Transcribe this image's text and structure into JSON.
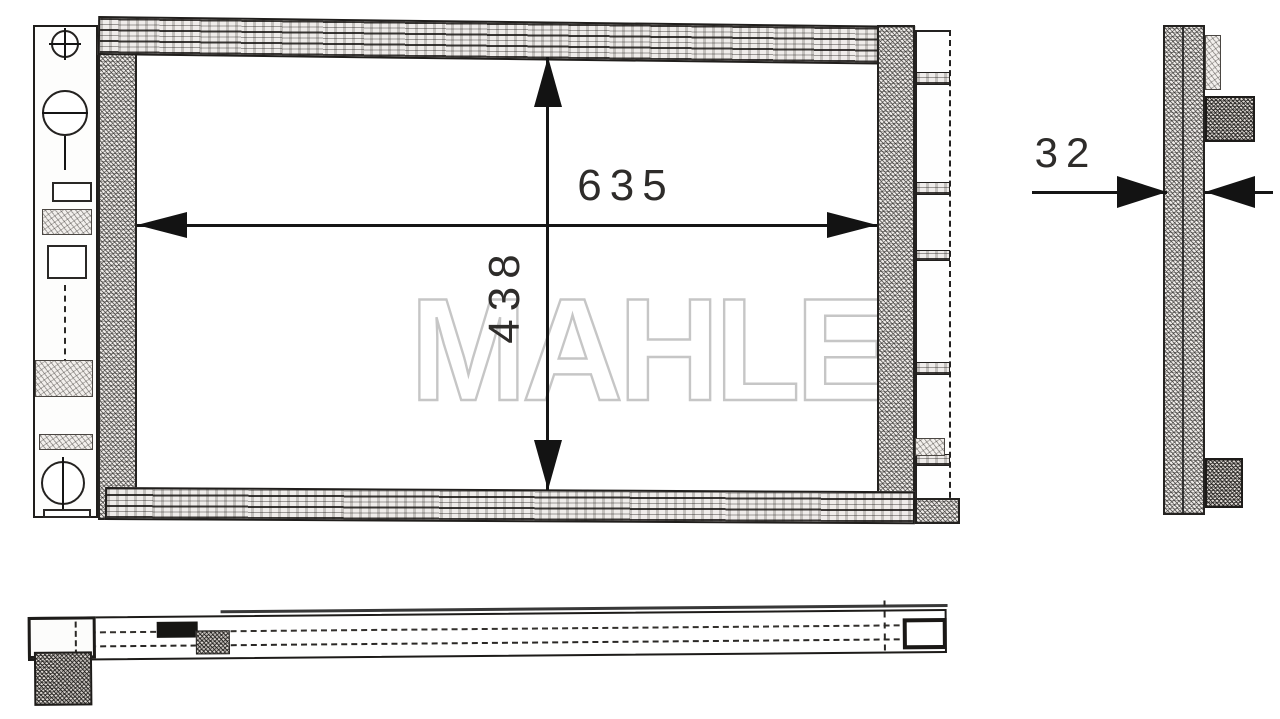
{
  "scene": {
    "type": "technical-line-drawing",
    "background": "#ffffff"
  },
  "watermark": {
    "text": "MAHLE",
    "stroke_color": "#c6c6c6"
  },
  "drawing": {
    "views": [
      {
        "id": "front",
        "label": "front-view"
      },
      {
        "id": "side",
        "label": "side-profile-view"
      },
      {
        "id": "bottom",
        "label": "bottom-view"
      }
    ],
    "dimensions": [
      {
        "view": "front",
        "axis": "horizontal",
        "value": "635"
      },
      {
        "view": "front",
        "axis": "vertical",
        "value": "438"
      },
      {
        "view": "side",
        "axis": "horizontal",
        "value": "32"
      }
    ]
  },
  "colors": {
    "line": "#1c1c1c",
    "hatch_bg": "#efece9",
    "dim_text": "#2e2c2a"
  }
}
